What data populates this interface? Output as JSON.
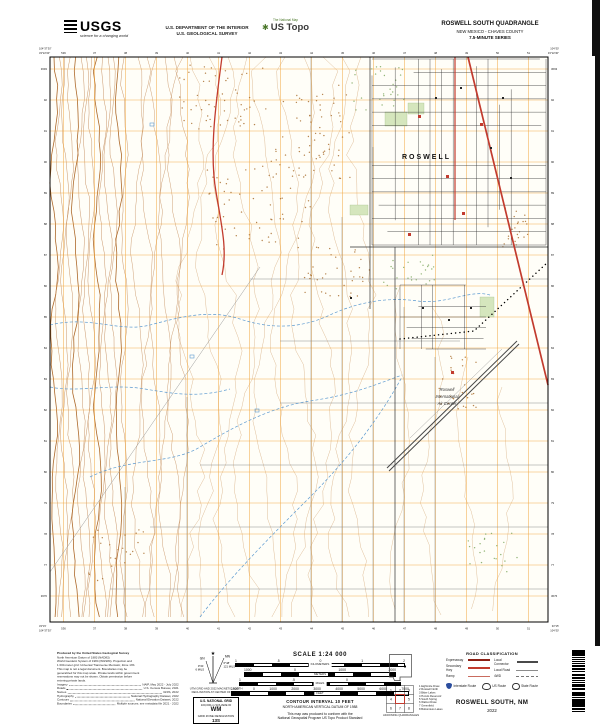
{
  "header": {
    "usgs_logo_text": "USGS",
    "usgs_tagline": "science for a changing world",
    "dept_line1": "U.S. DEPARTMENT OF THE INTERIOR",
    "dept_line2": "U.S. GEOLOGICAL SURVEY",
    "ustopo_over": "The National Map",
    "ustopo_name": "US Topo",
    "quad_title": "ROSWELL SOUTH QUADRANGLE",
    "quad_subtitle": "NEW MEXICO - CHAVES COUNTY",
    "quad_series": "7.5-MINUTE SERIES"
  },
  "map": {
    "labels": {
      "city": "ROSWELL",
      "airport": [
        "Roswell",
        "International",
        "Air Center"
      ]
    },
    "corners": {
      "tl_lon": "104°37'30\"",
      "tl_lat": "33°22'30\"",
      "tr_lon": "104°30'",
      "tr_lat": "33°22'30\"",
      "bl_lon": "104°37'30\"",
      "bl_lat": "33°15'",
      "br_lon": "104°30'",
      "br_lat": "33°15'"
    },
    "grid_labels": {
      "top": [
        "536",
        "37",
        "38",
        "39",
        "40",
        "41",
        "42",
        "43",
        "44",
        "45",
        "46",
        "47",
        "48",
        "49",
        "50",
        "51"
      ],
      "side": [
        "3693",
        "92",
        "91",
        "90",
        "89",
        "88",
        "87",
        "86",
        "85",
        "84",
        "83",
        "82",
        "81",
        "80",
        "79",
        "78",
        "77",
        "3676"
      ]
    },
    "colors": {
      "background": "#fffef8",
      "utm_grid": "#f0a43c",
      "contour": "#c08552",
      "contour_index": "#a9611f",
      "contour_faint": "#ddbb95",
      "water": "#5c9ad0",
      "vegetation": "#7fa860",
      "brush_brown": "#a96f2f",
      "highway_red": "#c23b2e",
      "street_black": "#2e2e2e",
      "local_gray": "#8c8c8c",
      "runway_gray": "#474747"
    }
  },
  "footer": {
    "credits": {
      "title": "Produced by the United States Geological Survey",
      "lines": [
        "North American Datum of 1983 (NAD83)",
        "World Geodetic System of 1984 (WGS84).  Projection and",
        "1 000-meter grid: Universal Transverse Mercator, Zone 13S",
        "This map is not a legal document. Boundaries may be",
        "generalized for this map scale. Private lands within government",
        "reservations may not be shown. Obtain permission before",
        "entering private lands."
      ],
      "sources": [
        [
          "Imagery",
          "NAIP, May 2022 - July 2022"
        ],
        [
          "Roads",
          "U.S. Census Bureau, 2021"
        ],
        [
          "Names",
          "GNIS, 2022"
        ],
        [
          "Hydrography",
          "National Hydrography Dataset, 2022"
        ],
        [
          "Contours",
          "National Elevation Dataset, 2022"
        ],
        [
          "Boundaries",
          "Multiple sources; see metadata file 2021 - 2022"
        ]
      ]
    },
    "declination": {
      "star": "★",
      "gn_label": "GN",
      "gn_angle": "0°21'",
      "gn_mils": "6 MILS",
      "mn_label": "MN",
      "mn_angle": "6°48'",
      "mn_mils": "121 MILS",
      "caption1": "UTM GRID AND 2022 MAGNETIC NORTH",
      "caption2": "DECLINATION AT CENTER OF SHEET"
    },
    "usng": {
      "title": "U.S. NATIONAL GRID",
      "subtitle": "100,000-m SQUARE ID",
      "square_id": "WM",
      "zone_label": "GRID ZONE DESIGNATION",
      "zone": "13S"
    },
    "scale": {
      "heading": "SCALE 1:24 000",
      "bars": [
        {
          "unit": "KILOMETERS",
          "ticks": [
            "1",
            ".5",
            "0",
            "1",
            "2"
          ]
        },
        {
          "unit": "METERS",
          "ticks": [
            "1000",
            "0",
            "1000",
            "2000"
          ]
        },
        {
          "unit": "MILES",
          "ticks": [
            "1",
            ".5",
            "0",
            "1"
          ]
        },
        {
          "unit": "FEET",
          "ticks": [
            "1000",
            "0",
            "1000",
            "2000",
            "3000",
            "4000",
            "5000",
            "6000",
            "7000"
          ]
        }
      ],
      "contour_interval": "CONTOUR INTERVAL 10 FEET",
      "vertical_datum": "NORTH AMERICAN VERTICAL DATUM OF 1988",
      "standard1": "This map was produced to conform with the",
      "standard2": "National Geospatial Program US Topo Product Standard"
    },
    "adjoining": {
      "caption": "ADJOINING QUADRANGLES",
      "names": [
        "Eightmile Draw",
        "Roswell North",
        "Bitter Lakes",
        "Hondo Reservoir",
        "South Spring",
        "Walnut Draw",
        "Greenfield",
        "Bottomless Lakes"
      ]
    },
    "road_class": {
      "title": "ROAD CLASSIFICATION",
      "left": [
        {
          "label": "Expressway",
          "style": "expressway"
        },
        {
          "label": "Secondary Hwy",
          "style": "secondary"
        },
        {
          "label": "Ramp",
          "style": "ramp"
        }
      ],
      "right": [
        {
          "label": "Local Connector",
          "style": "connector"
        },
        {
          "label": "Local Road",
          "style": "local"
        },
        {
          "label": "4WD",
          "style": "fourwd"
        }
      ],
      "routes": [
        {
          "icon": "interstate-shield",
          "label": "Interstate Route"
        },
        {
          "icon": "us-route-shield",
          "label": "US Route"
        },
        {
          "icon": "state-route-circle",
          "label": "State Route"
        }
      ]
    },
    "sheet_title": "ROSWELL SOUTH,  NM",
    "sheet_year": "2022"
  }
}
